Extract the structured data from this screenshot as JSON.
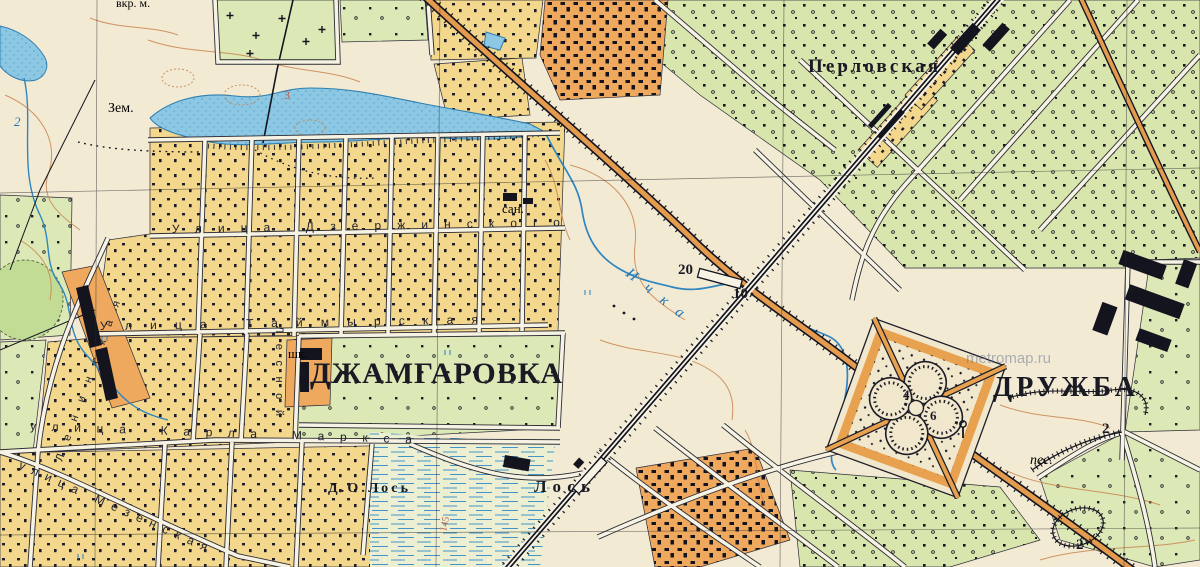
{
  "map": {
    "labels": {
      "settlements": {
        "dzhamgarovka": "ДЖАМГАРОВКА",
        "druzhba": "ДРУЖБА",
        "perlovskaya": "Перловская",
        "los_station": "Лось",
        "do_los": "Д.О.Лось"
      },
      "streets": {
        "dzerzhinskogo": "Улица Дзержинского",
        "taimyrskaya": "Улица Таймырская",
        "karla_marksa": "улица Карла Маркса",
        "mezenskaya": "улица Мезенская",
        "leninskaya": "Ленинская",
        "lesnoy": "Лесной"
      },
      "water": {
        "river": "Ичка",
        "depth": "2"
      },
      "marks": {
        "san": "сан.",
        "shk": "шк.",
        "zem": "Зем.",
        "pes": "пес.",
        "top_partial": "вкр. м."
      },
      "numbers": {
        "bridge_w": "20",
        "bridge_t": "10",
        "park_a": "4",
        "park_b": "6",
        "pit": "2",
        "plot": "2",
        "lake": "3",
        "contour": "145"
      },
      "watermark": "metromap.ru"
    },
    "colors": {
      "paper": "#f3ead4",
      "water": "#8cc8e4",
      "block_yellow": "#f3d78d",
      "block_orange": "#efa95f",
      "block_green": "#dce9b6",
      "road_orange": "#e59b4e",
      "ink": "#1d1d28",
      "contour": "#c8854f",
      "label_blue": "#2176b5"
    }
  }
}
